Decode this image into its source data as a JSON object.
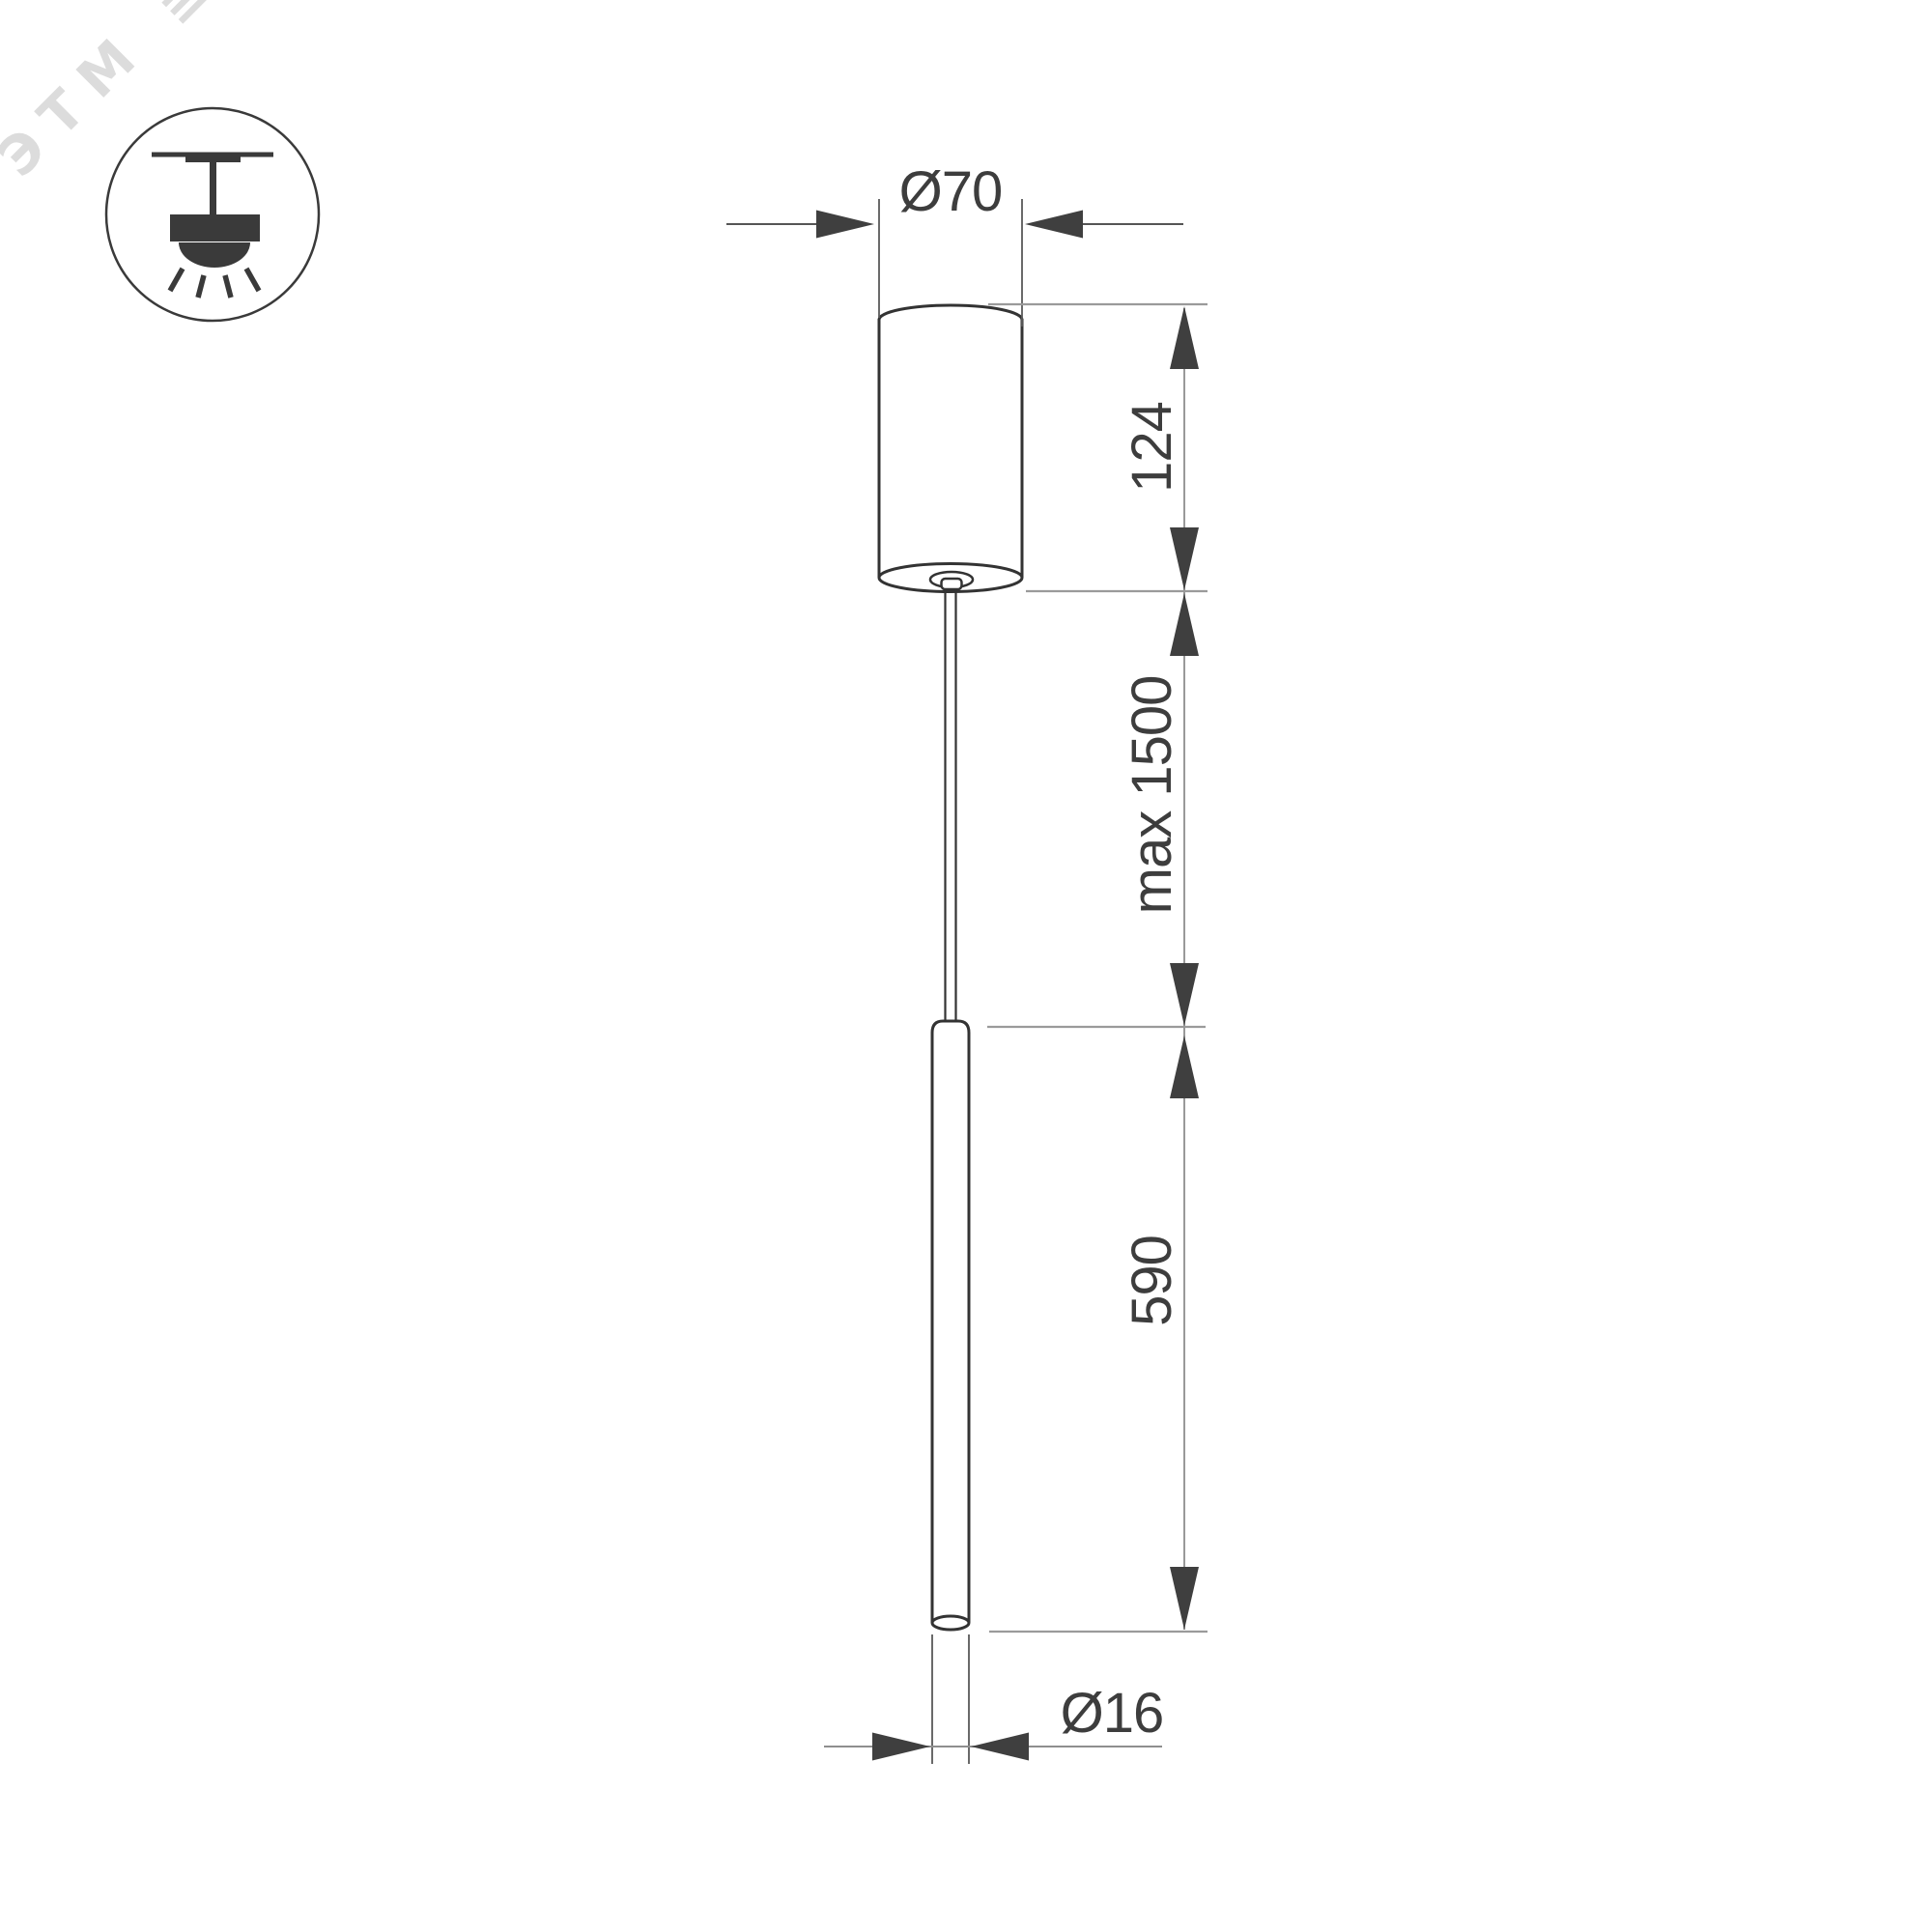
{
  "watermark": {
    "text": "ЭТМ",
    "mark": "≣"
  },
  "legend": {
    "icon": "pendant-ceiling-mount-icon"
  },
  "dimensions": {
    "canopy_diameter": {
      "label": "Ø70",
      "value": 70
    },
    "canopy_height": {
      "label": "124",
      "value": 124
    },
    "suspension_length": {
      "label": "max 1500",
      "value": 1500
    },
    "tube_length": {
      "label": "590",
      "value": 590
    },
    "tube_diameter": {
      "label": "Ø16",
      "value": 16
    }
  },
  "colors": {
    "background": "#ffffff",
    "ink": "#333333",
    "icon_ink": "#3a3a3a",
    "arrow": "#3f3f3f",
    "text": "#3d3d3d",
    "dim_line": "#555555",
    "vertical_dim_line": "#999999",
    "light_extension_line": "#9a9a9a",
    "watermark": "#dcdcdc"
  }
}
